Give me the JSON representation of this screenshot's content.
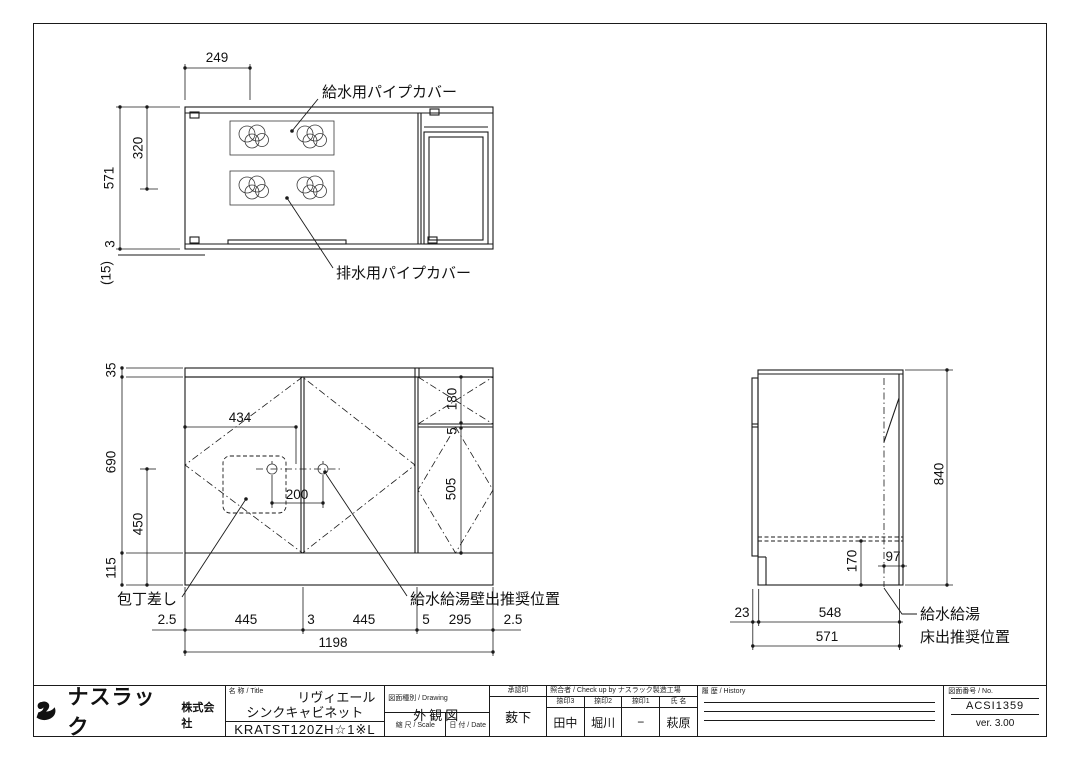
{
  "page": {
    "background": "#ffffff",
    "line_color": "#1a1a1a"
  },
  "plan": {
    "dims": {
      "w249": "249",
      "h571": "571",
      "h320": "320",
      "g3": "3",
      "p15": "(15)"
    },
    "labels": {
      "supply": "給水用パイプカバー",
      "drain": "排水用パイプカバー"
    }
  },
  "front": {
    "dims": {
      "t35": "35",
      "h690": "690",
      "h450": "450",
      "h115": "115",
      "w434": "434",
      "w200": "200",
      "h180": "180",
      "g5": "5",
      "h505": "505",
      "total": "1198",
      "bottom": [
        "2.5",
        "445",
        "3",
        "445",
        "5",
        "295",
        "2.5"
      ]
    },
    "labels": {
      "knife": "包丁差し",
      "wall": "給水給湯壁出推奨位置"
    }
  },
  "side": {
    "dims": {
      "h840": "840",
      "h170": "170",
      "w97": "97",
      "b23": "23",
      "b548": "548",
      "b571": "571"
    },
    "labels": {
      "floor1": "給水給湯",
      "floor2": "床出推奨位置"
    }
  },
  "title_block": {
    "company": {
      "name": "ナスラック",
      "suffix": "株式会社"
    },
    "title": {
      "header": "名 称 / Title",
      "line1": "リヴィエール",
      "line2": "シンクキャビネット",
      "model": "KRATST120ZH☆1※L"
    },
    "drawing": {
      "header": "図面種別 / Drawing",
      "value": "外観図",
      "scale_header": "縮 尺 / Scale",
      "scale": "S=1/10",
      "date_header": "日 付 / Date",
      "date": "2015.09.30"
    },
    "approval": {
      "header": "承認印",
      "name": "薮下"
    },
    "checkup": {
      "header": "照合者 / Check up by ナスラック製造工場",
      "cols": [
        {
          "header": "捺印3",
          "value": "田中"
        },
        {
          "header": "捺印2",
          "value": "堀川"
        },
        {
          "header": "捺印1",
          "value": "−"
        },
        {
          "header": "氏 名",
          "value": "萩原"
        }
      ]
    },
    "history": {
      "header": "履 歴 / History"
    },
    "number": {
      "header": "図面番号 / No.",
      "value": "ACSI1359",
      "version": "ver. 3.00"
    }
  }
}
